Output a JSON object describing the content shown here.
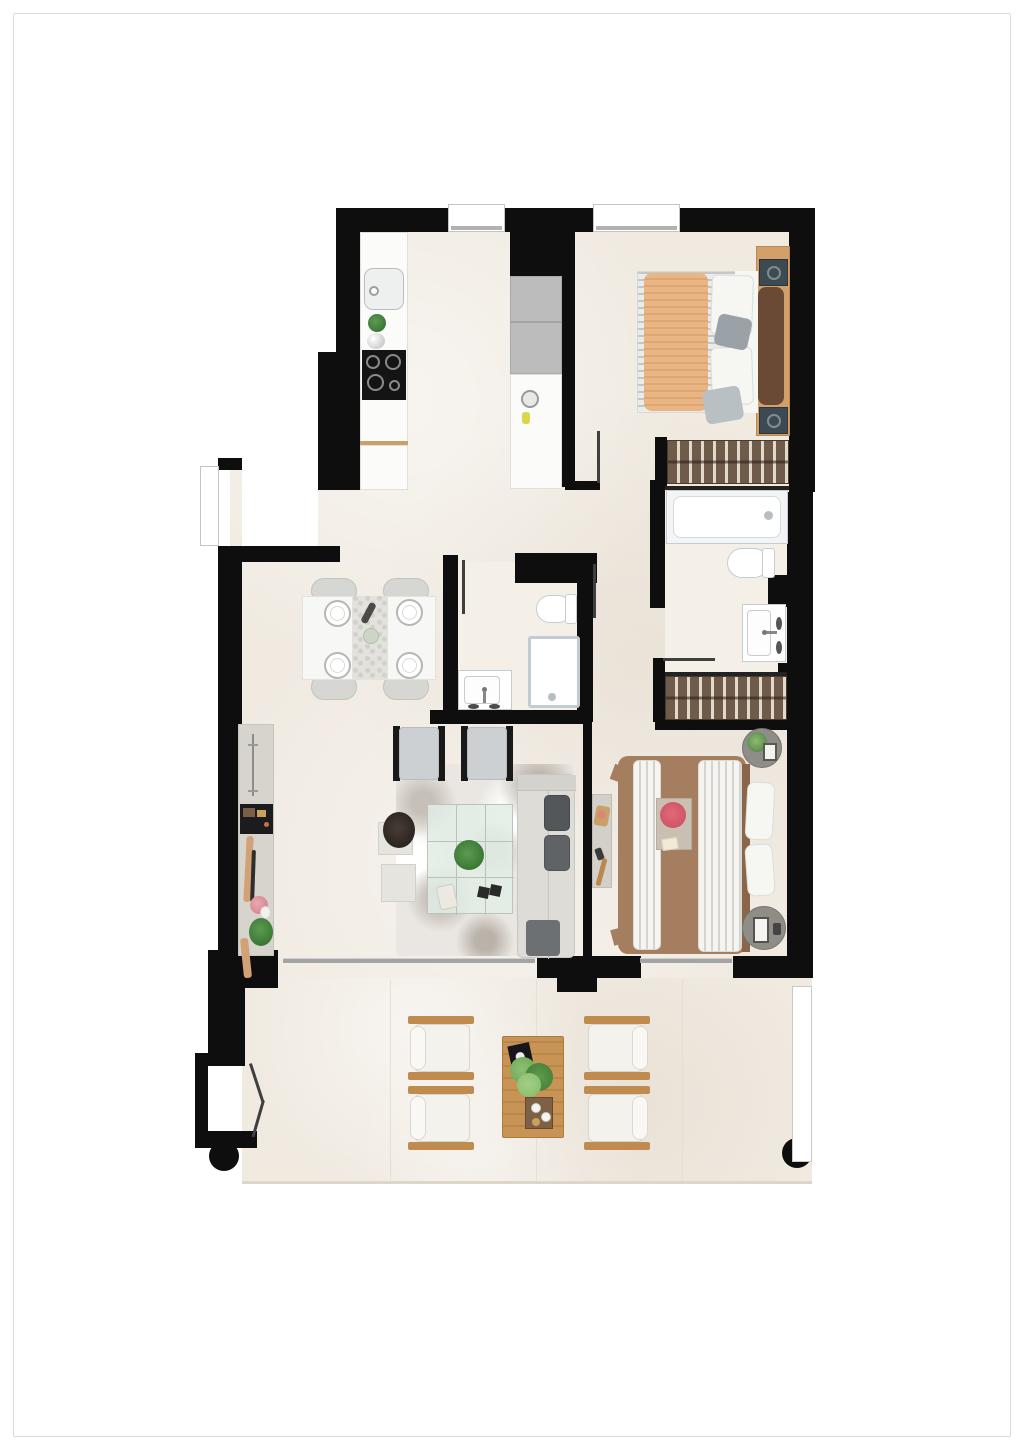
{
  "document": {
    "type": "apartment-floor-plan",
    "view": "top-down-rendered",
    "visible_text": "none"
  },
  "palette": {
    "page": "#ffffff",
    "frame_border": "#dbdbdb",
    "wall": "#0e0e0e",
    "floor": "#f0eae1",
    "floor_light": "#f4efe7",
    "counter": "#fbfbfa",
    "appliance_gray": "#bcbcbc",
    "cooktop": "#141414",
    "wood": "#d3a06b",
    "wardrobe": "#6f5b49",
    "wardrobe_stripe": "#e2d9cb",
    "bed_orange": "#e9b585",
    "mattress": "#ebebe9",
    "pillow_white": "#f6f6f3",
    "headboard_cushion": "#6a4a34",
    "nightstand": "#3e4a52",
    "bedding_brown": "#a57e60",
    "duvet": "#f5f4f1",
    "table_white": "#f7f7f5",
    "chair_gray": "#d6d6d2",
    "plate_rim": "#b6b6b3",
    "sideboard": "#d7d4ce",
    "tv_black": "#1c1c1e",
    "armchair": "#ccd0d2",
    "rail_black": "#191919",
    "rug": "#eae7e2",
    "glass": "#e4efe7",
    "glass_line": "#b7c2b8",
    "sofa": "#dedcd7",
    "sofa_cushion": "#54575a",
    "ottoman": "#6d7072",
    "round_table": "#8f8d88",
    "desk": "#d3d0ca",
    "terrace_wood": "#c08b4f",
    "terrace_table": "#c89455",
    "terrace_cushion": "#f4f2ed",
    "plant_green": "#4c8a46",
    "fixture_border": "#c6cdd2",
    "door_line": "#3f3f3f",
    "slider_gray": "#a4a4a4",
    "railing_border": "#c9c9c9"
  },
  "plan": {
    "rooms": [
      "kitchen",
      "hallway",
      "master-bedroom",
      "wardrobe-area",
      "bathroom-1",
      "bathroom-2",
      "living-dining-room",
      "bedroom-2",
      "terrace"
    ],
    "openings": {
      "windows": 3,
      "sliding_terrace_doors": 2,
      "entrance_door": 1,
      "interior_door_leaves": 4
    },
    "structure": {
      "columns": 2,
      "terrace_railing": 1
    }
  },
  "furniture": {
    "kitchen": [
      "sink-icon",
      "faucet-icon",
      "plant-icon",
      "cooktop-icon",
      "counter-run",
      "tall-cabinet-fridge",
      "island-counter"
    ],
    "master_bedroom": [
      "double-bed",
      "orange-throw",
      "pillows",
      "headboard-panel",
      "nightstand-icon",
      "nightstand-icon",
      "wardrobe-rail"
    ],
    "bathroom_1": [
      "bathtub-icon",
      "toilet-icon",
      "washbasin-icon",
      "wardrobe-rail"
    ],
    "bathroom_2": [
      "toilet-icon",
      "shower-icon",
      "washbasin-icon"
    ],
    "living_dining": [
      "dining-table",
      "dining-chair",
      "dining-chair",
      "dining-chair",
      "dining-chair",
      "place-setting",
      "table-runner",
      "sideboard",
      "tv-icon",
      "decor-items",
      "armchair",
      "armchair",
      "area-rug",
      "glass-coffee-table",
      "plant-icon",
      "sofa",
      "ottoman",
      "side-table",
      "side-table",
      "basket-plant"
    ],
    "bedroom_2": [
      "double-bed",
      "brown-bedspread",
      "striped-duvet",
      "breakfast-tray",
      "flowers-icon",
      "bedside-table",
      "bedside-table",
      "desk-console"
    ],
    "terrace": [
      "lounge-chair",
      "lounge-chair",
      "lounge-chair",
      "lounge-chair",
      "wood-coffee-table",
      "plant-icon",
      "book-icon",
      "serving-tray",
      "column",
      "column",
      "railing"
    ]
  }
}
